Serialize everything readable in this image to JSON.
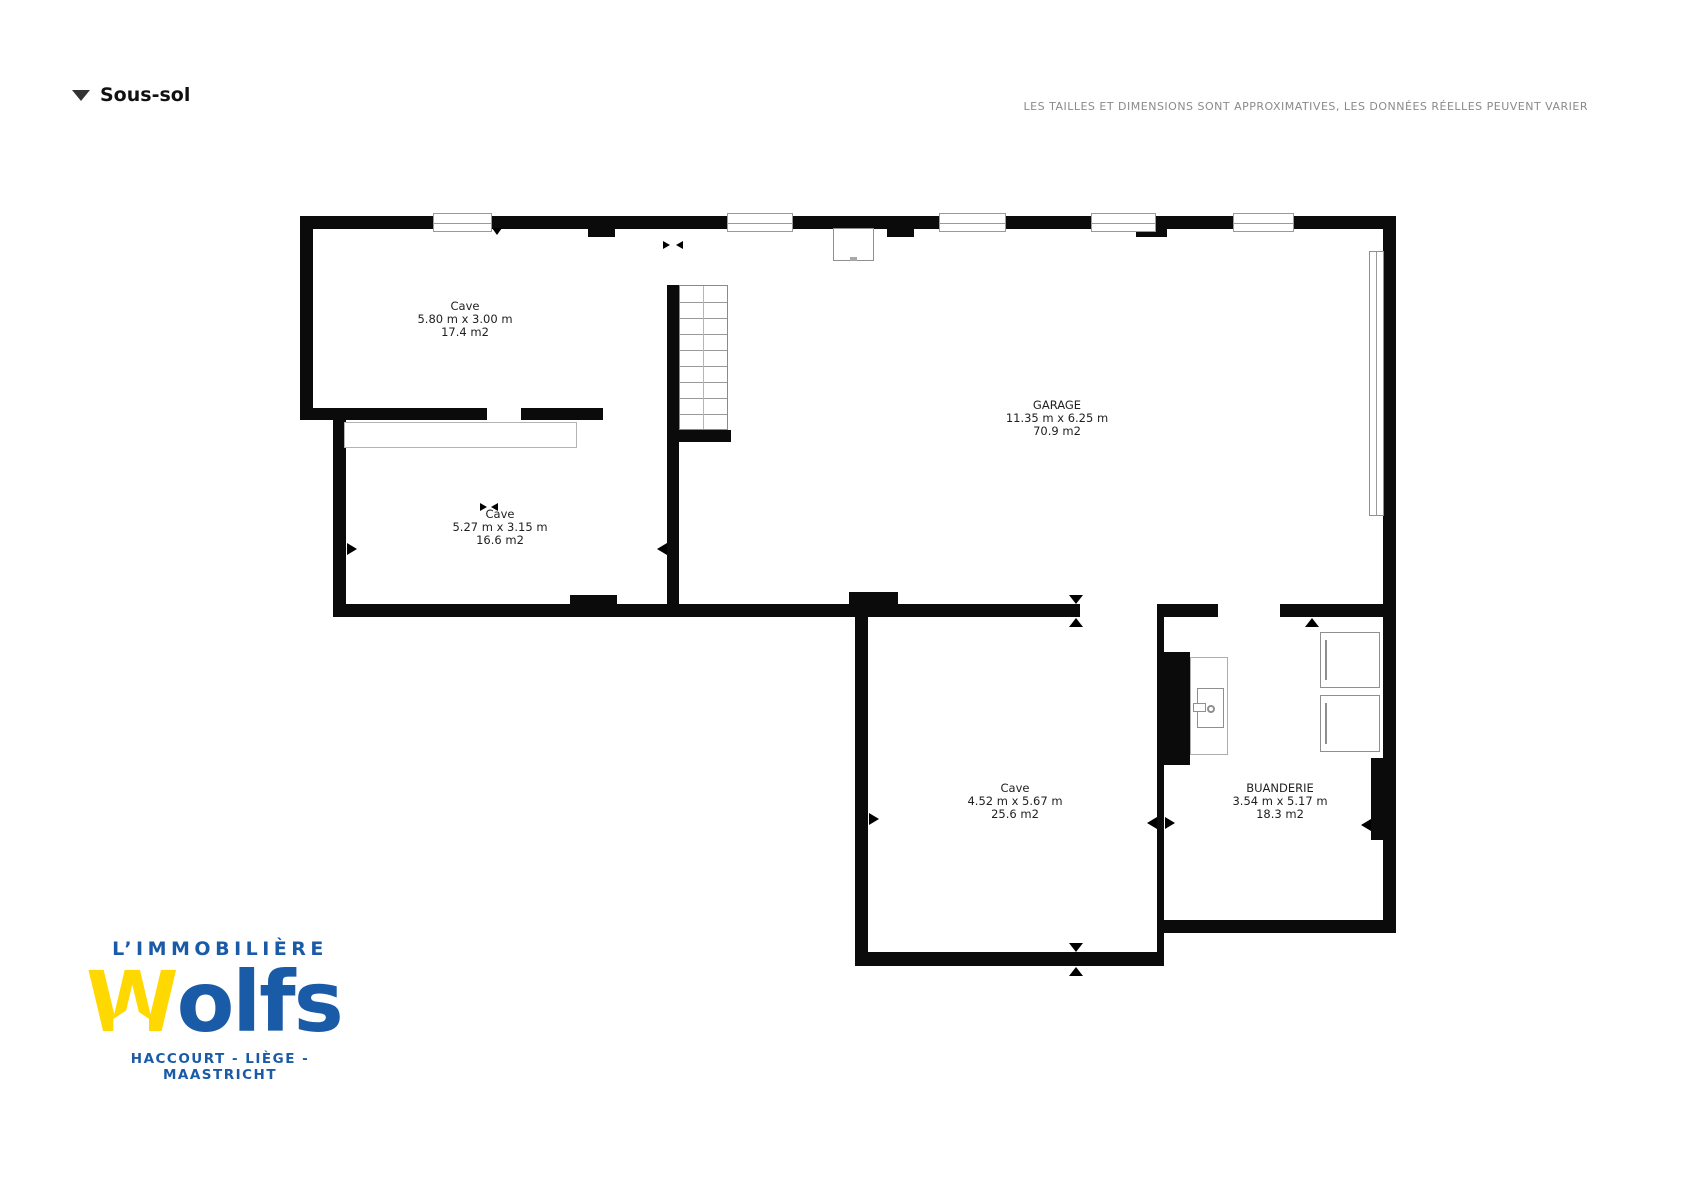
{
  "header": {
    "collapse_icon": "triangle-down",
    "title": "Sous-sol",
    "disclaimer": "LES TAILLES ET DIMENSIONS SONT APPROXIMATIVES, LES DONNÉES RÉELLES PEUVENT VARIER"
  },
  "floorplan": {
    "rooms": [
      {
        "name": "Cave",
        "dimensions": "5.80 m x 3.00 m",
        "area": "17.4 m2"
      },
      {
        "name": "Cave",
        "dimensions": "5.27 m x 3.15 m",
        "area": "16.6 m2"
      },
      {
        "name": "GARAGE",
        "dimensions": "11.35 m x 6.25 m",
        "area": "70.9 m2"
      },
      {
        "name": "Cave",
        "dimensions": "4.52 m x 5.67 m",
        "area": "25.6 m2"
      },
      {
        "name": "BUANDERIE",
        "dimensions": "3.54 m x 5.17 m",
        "area": "18.3 m2"
      }
    ]
  },
  "logo": {
    "line1": "L’IMMOBILIÈRE",
    "brand_w": "W",
    "brand_rest": "olfs",
    "cities": "HACCOURT - LIÈGE - MAASTRICHT",
    "colors": {
      "blue": "#1a5ba8",
      "yellow": "#ffd800"
    }
  },
  "colors": {
    "wall": "#0b0b0b",
    "background": "#ffffff",
    "disclaimer_text": "#8a8a8a"
  }
}
